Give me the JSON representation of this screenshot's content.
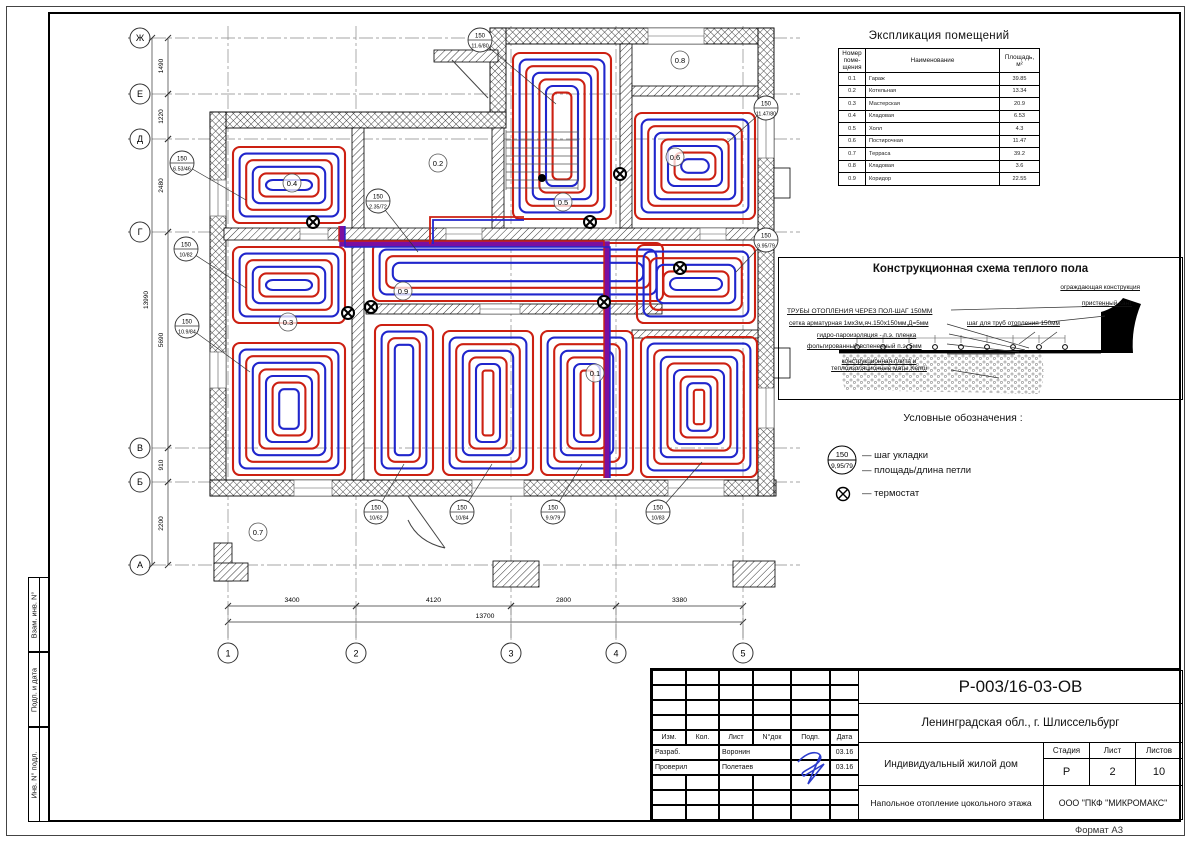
{
  "page": {
    "format_label": "Формат А3"
  },
  "stamp_side": {
    "items": [
      "Взам. инв. N°",
      "Подп. и дата",
      "Инв. N° подл."
    ]
  },
  "schedule": {
    "title": "Экспликация помещений",
    "headers": {
      "num": "Номер\nпоме-\nщения",
      "name": "Наименование",
      "area": "Площадь,\nм²"
    },
    "rows": [
      [
        "0.1",
        "Гараж",
        "39.85"
      ],
      [
        "0.2",
        "Котельная",
        "13.34"
      ],
      [
        "0.3",
        "Мастерская",
        "20.9"
      ],
      [
        "0.4",
        "Кладовая",
        "6.53"
      ],
      [
        "0.5",
        "Холл",
        "4.3"
      ],
      [
        "0.6",
        "Постирочная",
        "11.47"
      ],
      [
        "0.7",
        "Терраса",
        "39.2"
      ],
      [
        "0.8",
        "Кладовая",
        "3.6"
      ],
      [
        "0.9",
        "Коридор",
        "22.55"
      ]
    ]
  },
  "scheme": {
    "title": "Конструкционная схема теплого пола",
    "label_pipes": "ТРУБЫ ОТОПЛЕНИЯ ЧЕРЕЗ ПОЛ-ШАГ 150ММ",
    "label_mesh": "сетка арматурная 1мх3м,яч.150х150мм,Д=5мм",
    "label_hydro": "гидро-пароизоляция - п.э. пленка",
    "label_foil": "фольгированный вспененный п.э. 5мм",
    "label_plate": "конструкционная плита и\nтеплоизоляционные маты Kermi",
    "label_step": "шаг для труб отопления 150мм",
    "label_enclosure": "ограждающая конструкция",
    "label_skirt": "пристенный кант"
  },
  "legend": {
    "title": "Условные обозначения :",
    "symbol_top": "150",
    "symbol_bottom": "9,95/79",
    "step_label": "— шаг укладки",
    "loop_label": "— площадь/длина петли",
    "thermostat_label": "— термостат"
  },
  "titleblock": {
    "doc_number": "Р-003/16-03-ОВ",
    "location": "Ленинградская обл., г. Шлиссельбург",
    "object": "Индивидуальный жилой дом",
    "sheet_title": "Напольное отопление цокольного этажа",
    "company": "ООО \"ПКФ \"МИКРОМАКС\"",
    "cols": [
      "Изм.",
      "Кол.",
      "Лист",
      "N°док",
      "Подп.",
      "Дата"
    ],
    "sign_rows": [
      {
        "role": "Разраб.",
        "name": "Воронин",
        "date": "03.16"
      },
      {
        "role": "Проверил",
        "name": "Полетаев",
        "date": "03.16"
      }
    ],
    "stage_label": "Стадия",
    "sheet_label": "Лист",
    "sheets_label": "Листов",
    "stage": "Р",
    "sheet": "2",
    "sheets": "10"
  },
  "plan": {
    "colors": {
      "red": "#cc2012",
      "blue": "#2026cc",
      "trunk": "#7b0fa0"
    },
    "axes_rows": [
      {
        "label": "Ж",
        "y": 38
      },
      {
        "label": "Е",
        "y": 94
      },
      {
        "label": "Д",
        "y": 139
      },
      {
        "label": "Г",
        "y": 232
      },
      {
        "label": "В",
        "y": 448
      },
      {
        "label": "Б",
        "y": 482
      },
      {
        "label": "А",
        "y": 565
      }
    ],
    "axes_cols": [
      {
        "label": "1",
        "x": 228
      },
      {
        "label": "2",
        "x": 356
      },
      {
        "label": "3",
        "x": 511
      },
      {
        "label": "4",
        "x": 616
      },
      {
        "label": "5",
        "x": 743
      }
    ],
    "dims_left": [
      {
        "text": "1490",
        "from": 38,
        "to": 94
      },
      {
        "text": "1220",
        "from": 94,
        "to": 139
      },
      {
        "text": "2480",
        "from": 139,
        "to": 232
      },
      {
        "text": "5690",
        "from": 232,
        "to": 448
      },
      {
        "text": "910",
        "from": 448,
        "to": 482
      },
      {
        "text": "2200",
        "from": 482,
        "to": 565
      }
    ],
    "dim_left_total": "13990",
    "dims_bottom": [
      {
        "text": "3400",
        "from": 228,
        "to": 356
      },
      {
        "text": "4120",
        "from": 356,
        "to": 511
      },
      {
        "text": "2800",
        "from": 511,
        "to": 616
      },
      {
        "text": "3380",
        "from": 616,
        "to": 743
      }
    ],
    "dim_bottom_total": "13700",
    "room_labels": [
      {
        "text": "0.1",
        "x": 595,
        "y": 373
      },
      {
        "text": "0.2",
        "x": 438,
        "y": 163
      },
      {
        "text": "0.3",
        "x": 288,
        "y": 322
      },
      {
        "text": "0.4",
        "x": 292,
        "y": 183
      },
      {
        "text": "0.5",
        "x": 563,
        "y": 202
      },
      {
        "text": "0.6",
        "x": 675,
        "y": 157
      },
      {
        "text": "0.7",
        "x": 258,
        "y": 532
      },
      {
        "text": "0.8",
        "x": 680,
        "y": 60
      },
      {
        "text": "0.9",
        "x": 403,
        "y": 291
      }
    ],
    "callouts": [
      {
        "top": "150",
        "bottom": "11.6/80",
        "x": 480,
        "y": 40,
        "tx": 556,
        "ty": 104
      },
      {
        "top": "150",
        "bottom": "11.47/80",
        "x": 766,
        "y": 108,
        "tx": 728,
        "ty": 142
      },
      {
        "top": "150",
        "bottom": "9.95/79",
        "x": 766,
        "y": 240,
        "tx": 736,
        "ty": 272
      },
      {
        "top": "150",
        "bottom": "6.53/46",
        "x": 182,
        "y": 163,
        "tx": 246,
        "ty": 200
      },
      {
        "top": "150",
        "bottom": "10/82",
        "x": 186,
        "y": 249,
        "tx": 246,
        "ty": 288
      },
      {
        "top": "150",
        "bottom": "10.9/84",
        "x": 187,
        "y": 326,
        "tx": 250,
        "ty": 372
      },
      {
        "top": "150",
        "bottom": "2.35/72",
        "x": 378,
        "y": 201,
        "tx": 418,
        "ty": 252
      },
      {
        "top": "150",
        "bottom": "10/62",
        "x": 376,
        "y": 512,
        "tx": 404,
        "ty": 464
      },
      {
        "top": "150",
        "bottom": "10/84",
        "x": 462,
        "y": 512,
        "tx": 492,
        "ty": 464
      },
      {
        "top": "150",
        "bottom": "9.9/79",
        "x": 553,
        "y": 512,
        "tx": 582,
        "ty": 464
      },
      {
        "top": "150",
        "bottom": "10/83",
        "x": 658,
        "y": 512,
        "tx": 702,
        "ty": 462
      }
    ],
    "thermostats": [
      [
        313,
        222
      ],
      [
        590,
        222
      ],
      [
        620,
        174
      ],
      [
        348,
        313
      ],
      [
        371,
        307
      ],
      [
        604,
        302
      ],
      [
        680,
        268
      ]
    ]
  }
}
